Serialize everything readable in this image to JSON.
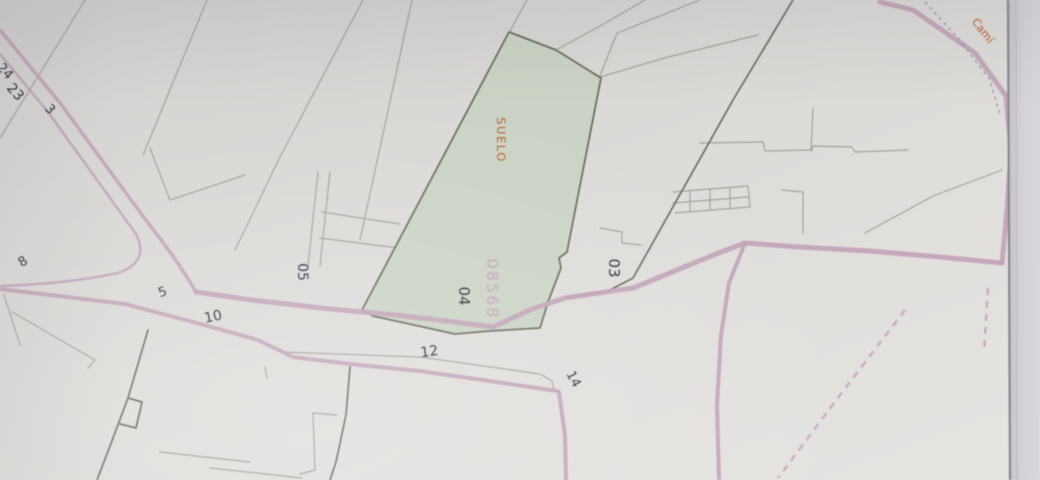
{
  "map": {
    "zone_label": "SUELO",
    "block_number": "08568",
    "road_name": "Camí",
    "labels": {
      "n24": "24",
      "n23": "23",
      "n3": "3",
      "n8": "8",
      "n5": "5",
      "n10": "10",
      "p05": "05",
      "p04": "04",
      "p03": "03",
      "n12": "12",
      "n14": "14"
    }
  },
  "colors": {
    "paper": "#dcdad7",
    "paper_edge_line": "#8a8890",
    "parcel_fill": "#c9d3c3",
    "parcel_border": "#6a7060",
    "road_pink": "#c3a3b8",
    "boundary_dark": "#6e6d68",
    "parcel_line_gray": "#a5a19d",
    "label_ink": "#33333d",
    "accent_orange": "#bf5f28",
    "block_number_pink": "#c7a4b8"
  }
}
